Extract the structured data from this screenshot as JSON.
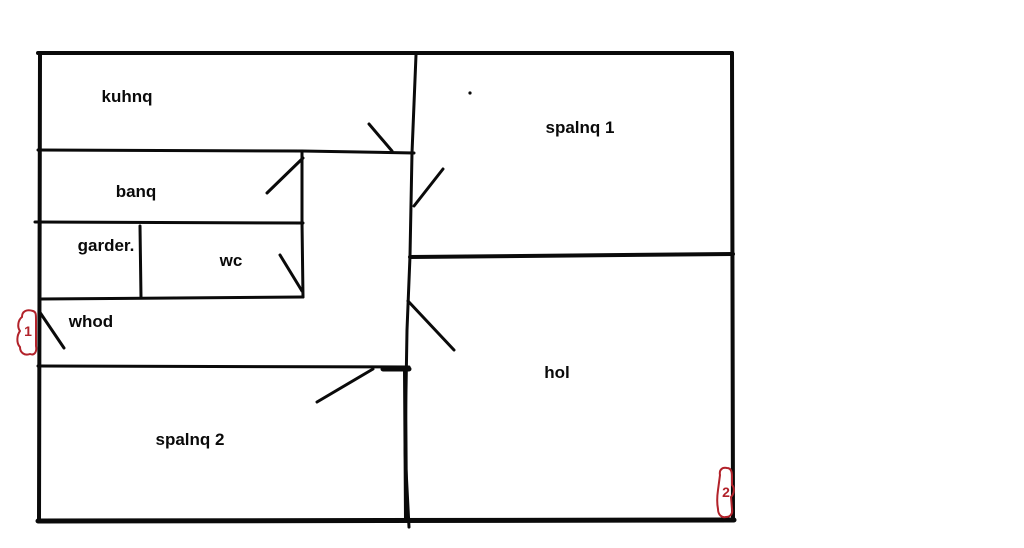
{
  "canvas": {
    "width": 1024,
    "height": 548,
    "background": "#ffffff",
    "ink": "#0a0a0a",
    "marker_red": "#b2222a"
  },
  "rooms": [
    {
      "id": "kuhnq",
      "label": "kuhnq"
    },
    {
      "id": "banq",
      "label": "banq"
    },
    {
      "id": "garder",
      "label": "garder."
    },
    {
      "id": "wc",
      "label": "wc"
    },
    {
      "id": "whod",
      "label": "whod"
    },
    {
      "id": "spalnq-1",
      "label": "spalnq 1"
    },
    {
      "id": "hol",
      "label": "hol"
    },
    {
      "id": "spalnq-2",
      "label": "spalnq 2"
    }
  ],
  "entrance_markers": [
    {
      "id": "entrance-1",
      "label": "1"
    },
    {
      "id": "entrance-2",
      "label": "2"
    }
  ]
}
